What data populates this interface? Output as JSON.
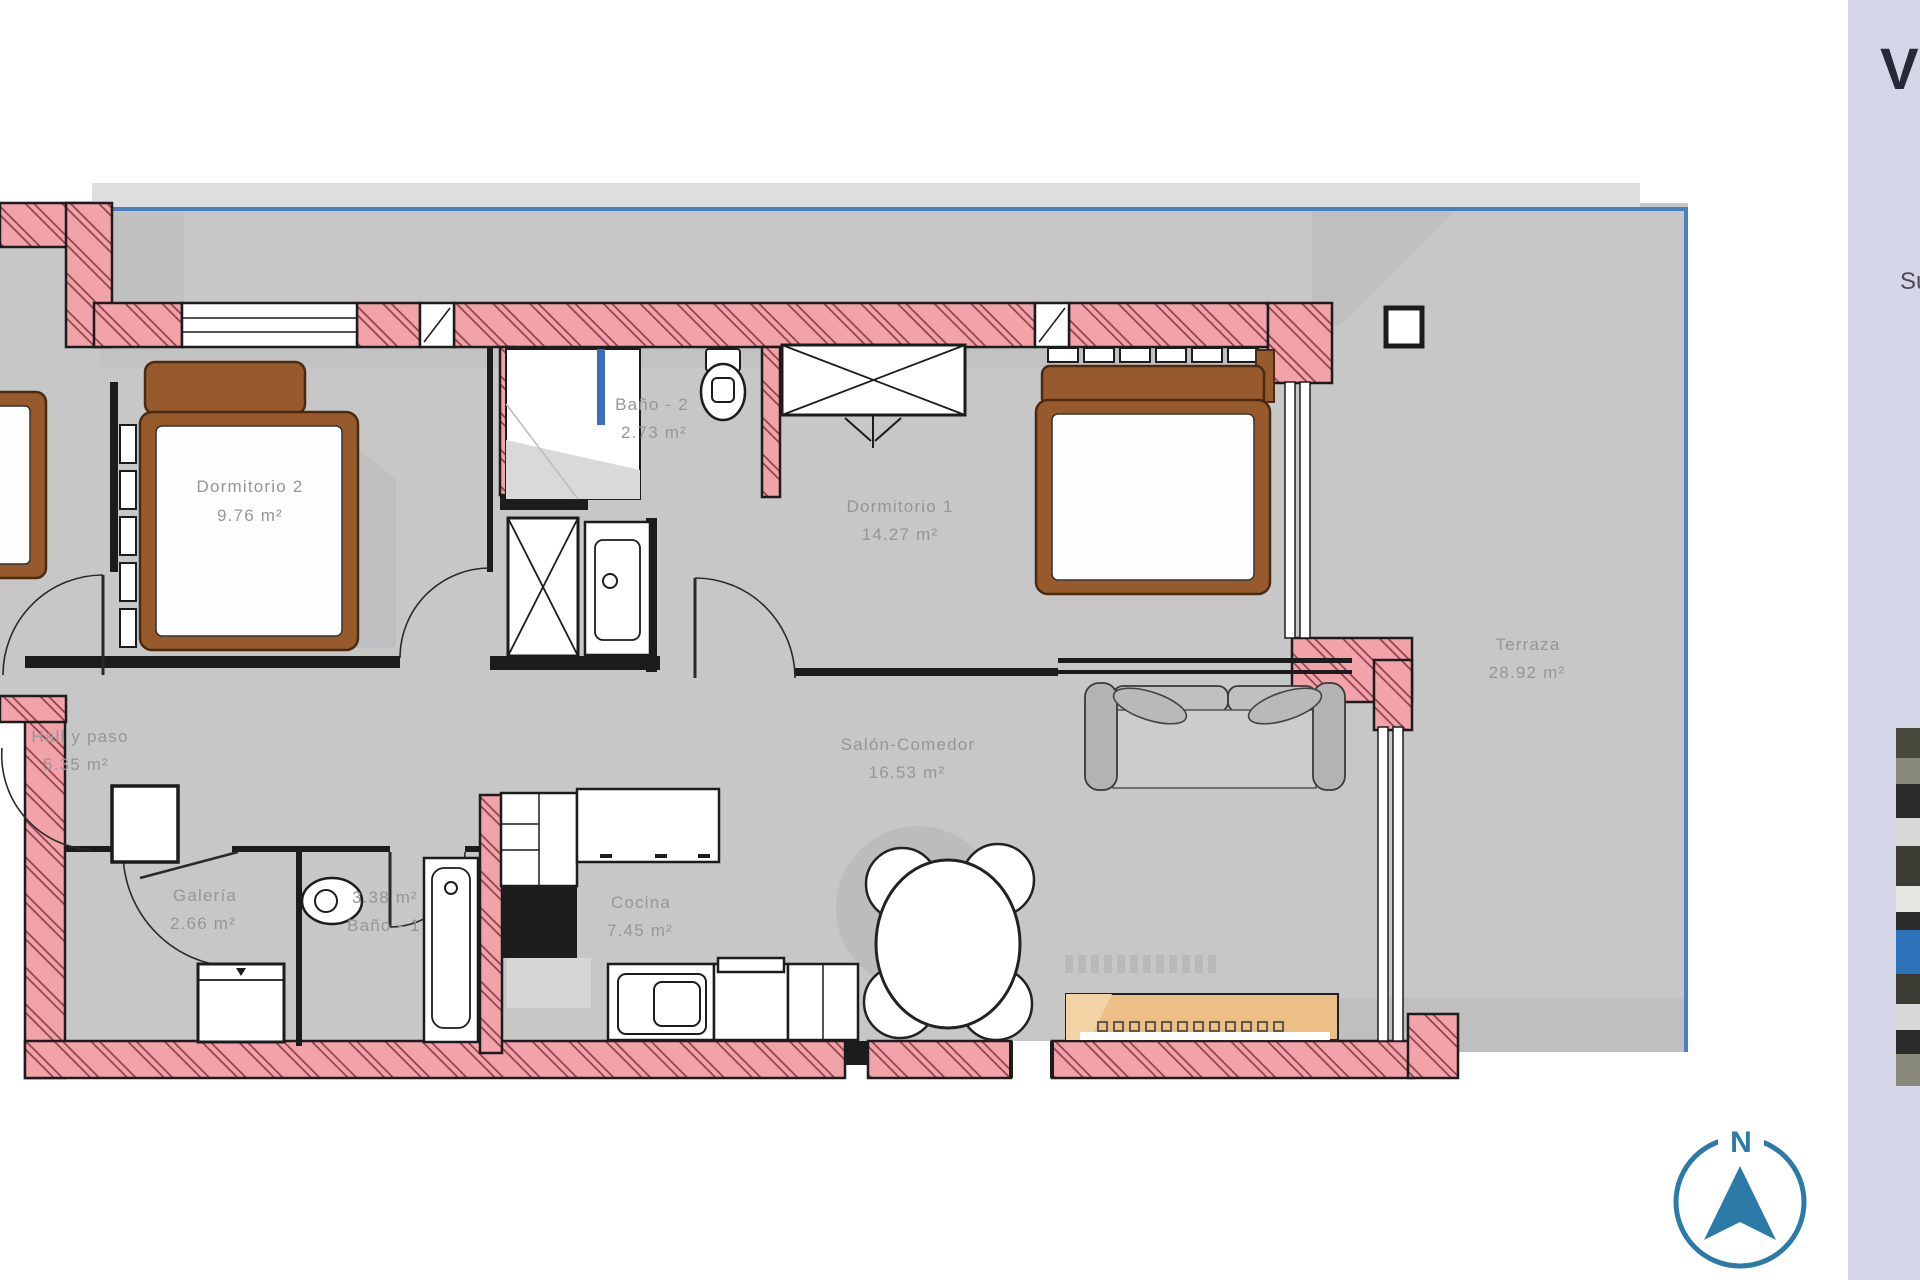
{
  "plan": {
    "rooms": [
      {
        "name": "Dormitorio 2",
        "area": "9.76 m²"
      },
      {
        "name": "Baño - 2",
        "area": "2.73 m²"
      },
      {
        "name": "Dormitorio 1",
        "area": "14.27 m²"
      },
      {
        "name": "Hall y paso",
        "area": "5.35 m²"
      },
      {
        "name": "Galería",
        "area": "2.66 m²"
      },
      {
        "name": "Baño - 1",
        "area": "3.38 m²"
      },
      {
        "name": "Cocina",
        "area": "7.45 m²"
      },
      {
        "name": "Salón-Comedor",
        "area": "16.53 m²"
      },
      {
        "name": "Terraza",
        "area": "28.92 m²"
      }
    ],
    "compass": {
      "north_label": "N"
    }
  },
  "sidebar": {
    "title_partial": "V",
    "subtitle_partial": "Su"
  },
  "colors": {
    "wall_pink": "#f2a3aa",
    "wall_hatch_line": "#8a3a42",
    "floor_gray": "#c7c7c8",
    "shadow_gray": "#bdbdbe",
    "boundary_blue": "#4a7fc1",
    "furniture_brown": "#965a2c",
    "sideboard_tan": "#ecbf86",
    "compass_blue": "#2c7aa8",
    "sidebar_bg": "#d5d6e8"
  }
}
